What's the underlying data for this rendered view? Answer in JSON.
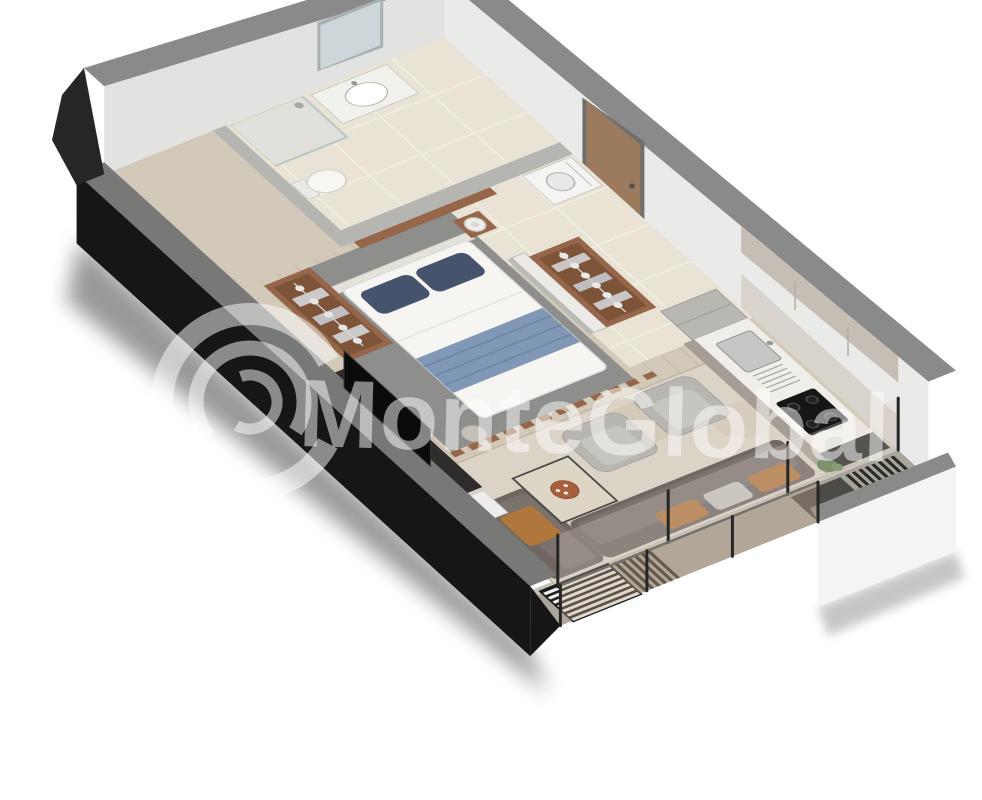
{
  "watermark": {
    "text": "MonteGlobal",
    "logo": "c-swirl-logo",
    "color": "#ffffff",
    "opacity": 0.5
  },
  "scene": {
    "type": "isometric-3d-floor-plan",
    "subject": "studio apartment dollhouse render, rotated diagonally on white background",
    "rooms": [
      {
        "name": "bathroom",
        "objects": [
          "wall-mirror",
          "vanity-with-sink",
          "toilet",
          "shower-corner"
        ]
      },
      {
        "name": "entry-hall",
        "objects": [
          "entry-door-wood",
          "washing-machine",
          "wood-panel-half-wall",
          "open-closet-with-hangers",
          "beige-floor-tiles"
        ]
      },
      {
        "name": "bedroom",
        "objects": [
          "double-bed-white",
          "navy-pillows",
          "blue-throw-blanket",
          "headboard",
          "bedside-table",
          "bedside-lamp",
          "wardrobe-with-hangers",
          "round-foot-stool",
          "wood-slat-partition",
          "grey-rug"
        ]
      },
      {
        "name": "kitchen",
        "objects": [
          "tall-grey-cabinet",
          "taupe-base-cabinets",
          "white-countertop",
          "stainless-sink",
          "dish-rack",
          "black-gas-cooktop",
          "black-end-unit",
          "potted-plant",
          "upper-cabinets"
        ]
      },
      {
        "name": "living-room",
        "objects": [
          "corner-sofa-grey",
          "rust-cushions",
          "light-cushion",
          "armchair",
          "armchair",
          "coffee-table",
          "decor-bowl",
          "tv-console-dark",
          "tv",
          "white-pedestal-cabinet",
          "beige-area-rug",
          "wood-plank-floor"
        ]
      },
      {
        "name": "balcony",
        "objects": [
          "glass-balustrade",
          "glass-sliding-wall",
          "dark-louver-fins",
          "striped-slat-screen",
          "outdoor-lounge-seat",
          "concrete-floor"
        ]
      }
    ]
  },
  "colors": {
    "bg": "#ffffff",
    "wallTop": "#8a8a8a",
    "wallTopDark": "#787876",
    "wallFace": "#eaeae8",
    "wallFaceDim": "#e2e2e0",
    "wallBlack": "#161616",
    "wallWedge": "#262626",
    "seWall": "#f4f4f2",
    "tile": "#e9e3d6",
    "tileLine": "#f3eee3",
    "wood": "#d3c9b8",
    "plank": "#c6bba8",
    "rugBed": "#8e8e8c",
    "rugLiv": "#dbd3c6",
    "rugLivEdge": "#c3b9a7",
    "rugLivTex": "#cdc2ae",
    "balconyFloor": "#a9a59d",
    "threshold": "#c6c2b8",
    "timber": "#96664a",
    "timberDark": "#7d5438",
    "furnWhite": "#f4f4f1",
    "steel": "#c6c6c4",
    "navy": "#46536d",
    "throwBlue": "#8097b5",
    "chair": "#b7b6b1",
    "chairCushion": "#c6c5c0",
    "sofa": "#6f6661",
    "sofaSeat": "#7b726c",
    "cushionRust": "#b0773c",
    "cushionLight": "#c7c3bc",
    "tableTop": "#ded6c5",
    "dark": "#242422",
    "plant": "#5d7a4b",
    "bowl": "#a85f3d",
    "glassTint": "#bfa98e",
    "doorWood": "#9b7a5e",
    "watermark": "#ffffff"
  }
}
